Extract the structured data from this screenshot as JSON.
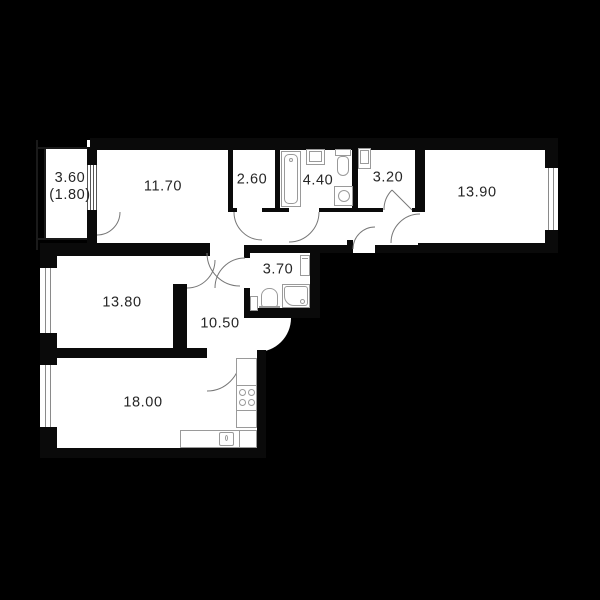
{
  "plan": {
    "title": "apartment-floor-plan",
    "colors": {
      "background": "#000000",
      "floor": "#ffffff",
      "wall": "#0a0a0a",
      "fixture_line": "#9a9a9a",
      "label_text": "#262626"
    },
    "rooms": [
      {
        "id": "balcony",
        "area": "3.60",
        "area_secondary": "(1.80)"
      },
      {
        "id": "bedroom-top",
        "area": "11.70"
      },
      {
        "id": "wardrobe",
        "area": "2.60"
      },
      {
        "id": "bathroom",
        "area": "4.40"
      },
      {
        "id": "entry-hall",
        "area": "3.20"
      },
      {
        "id": "bedroom-right",
        "area": "13.90"
      },
      {
        "id": "shower-room",
        "area": "3.70"
      },
      {
        "id": "bedroom-left",
        "area": "13.80"
      },
      {
        "id": "corridor",
        "area": "10.50"
      },
      {
        "id": "kitchen-living",
        "area": "18.00"
      }
    ],
    "fixtures": [
      "bathtub",
      "wash-basin",
      "toilet",
      "washing-machine",
      "shower-tray",
      "toilet-2",
      "wash-basin-2",
      "water-heater",
      "stove-4-burners",
      "kitchen-sink",
      "kitchen-counter",
      "hall-cabinet"
    ]
  }
}
